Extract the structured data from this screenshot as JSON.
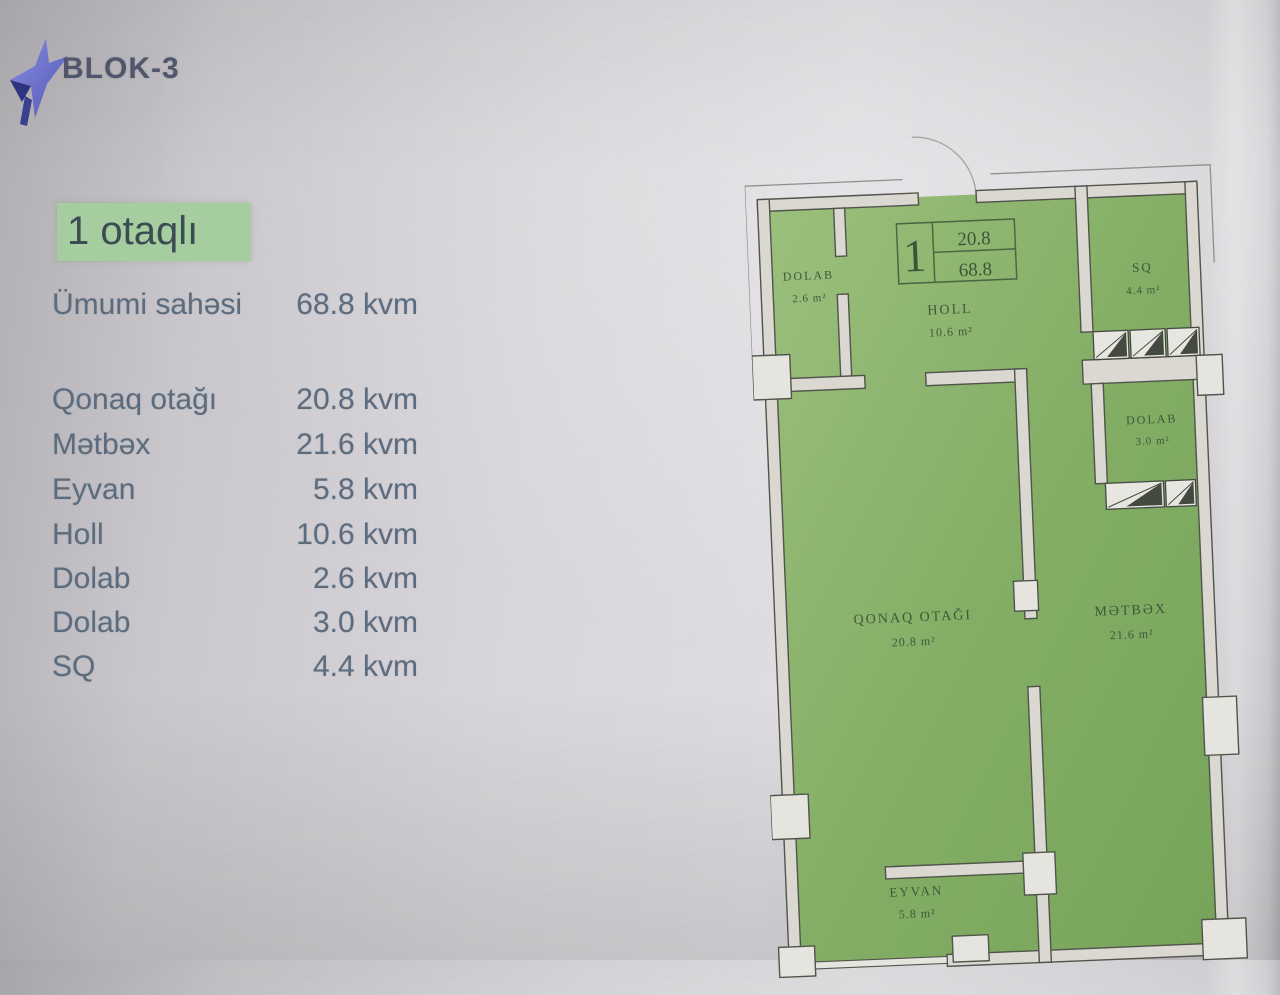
{
  "header": {
    "brand": "BLOK-3",
    "logo_icon": "star-logo"
  },
  "listing": {
    "type_label": "1 otaqlı",
    "summary": {
      "label": "Ümumi sahəsi",
      "value": "68.8 kvm"
    },
    "rooms": [
      {
        "label": "Qonaq otağı",
        "value": "20.8 kvm"
      },
      {
        "label": "Mətbəx",
        "value": "21.6 kvm"
      },
      {
        "label": "Eyvan",
        "value": "5.8 kvm"
      },
      {
        "label": "Holl",
        "value": "10.6 kvm"
      },
      {
        "label": "Dolab",
        "value": "2.6 kvm"
      },
      {
        "label": "Dolab",
        "value": "3.0 kvm"
      },
      {
        "label": "SQ",
        "value": "4.4 kvm"
      }
    ]
  },
  "plan": {
    "marker": {
      "unit": "1",
      "area_room": "20.8",
      "area_total": "68.8"
    },
    "rooms": [
      {
        "name": "DOLAB",
        "area": "2.6 m²"
      },
      {
        "name": "HOLL",
        "area": "10.6 m²"
      },
      {
        "name": "SQ",
        "area": "4.4 m²"
      },
      {
        "name": "DOLAB",
        "area": "3.0 m²"
      },
      {
        "name": "QONAQ OTAĞI",
        "area": "20.8 m²"
      },
      {
        "name": "MƏTBƏX",
        "area": "21.6 m²"
      },
      {
        "name": "EYVAN",
        "area": "5.8 m²"
      }
    ],
    "colors": {
      "room_fill": "#84ae66",
      "room_fill_light": "#9cc07e",
      "wall_fill": "#dbd8d1",
      "outline": "#50544a",
      "label": "#3e5838",
      "badge_bg": "#a5cd9f",
      "text_blue_gray": "#5c6c7e",
      "brand_color": "#51576a",
      "logo_blue": "#7177cd",
      "logo_navy": "#2e3480"
    }
  }
}
